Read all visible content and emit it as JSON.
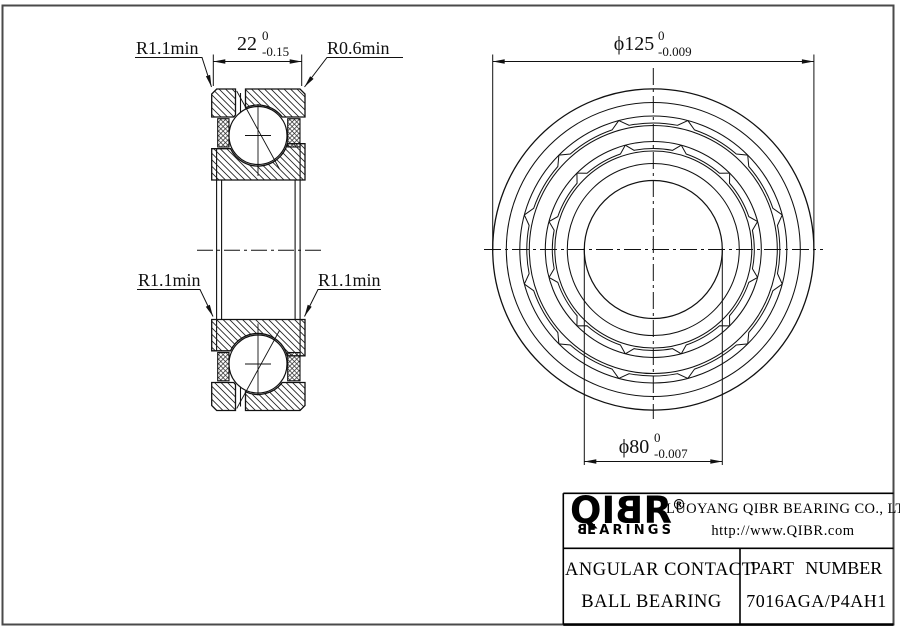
{
  "section_view": {
    "fillet_top_left": "R1.1min",
    "fillet_top_right": "R0.6min",
    "fillet_mid_left": "R1.1min",
    "fillet_mid_right": "R1.1min",
    "width_dim": {
      "nominal": "22",
      "upper_tol": "0",
      "lower_tol": "-0.15"
    }
  },
  "front_view": {
    "outer_diameter_dim": {
      "nominal": "ϕ125",
      "upper_tol": "0",
      "lower_tol": "-0.009"
    },
    "bore_diameter_dim": {
      "nominal": "ϕ80",
      "upper_tol": "0",
      "lower_tol": "-0.007"
    }
  },
  "title_block": {
    "logo_part1": "QI",
    "logo_part_b": "B",
    "logo_part2": "R",
    "logo_reg": "®",
    "logo_sub_b": "B",
    "logo_sub_rest": "EARINGS",
    "company": "LUOYANG QIBR BEARING CO., LTD",
    "website": "http://www.QIBR.com",
    "product_line1": "ANGULAR CONTACT",
    "product_line2": "BALL BEARING",
    "part_number_label": "PART NUMBER",
    "part_number": "7016AGA/P4AH1"
  }
}
